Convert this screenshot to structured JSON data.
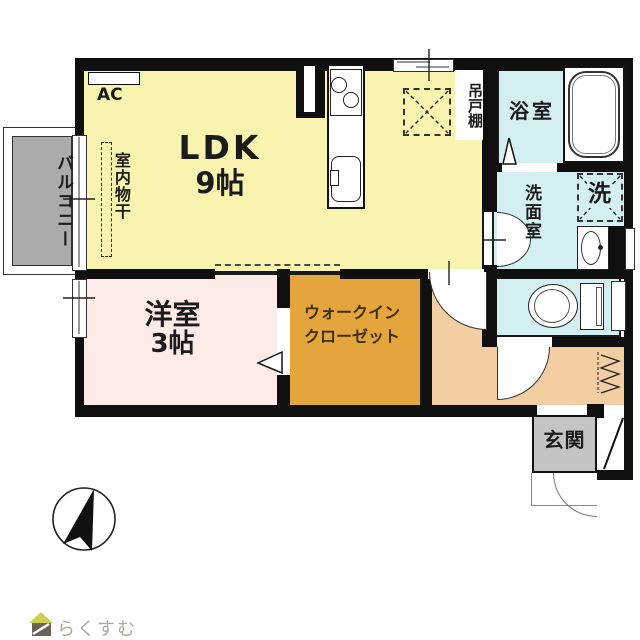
{
  "plan": {
    "rooms": {
      "ldk": {
        "name": "LDK",
        "size": "9帖"
      },
      "western_room": {
        "name": "洋室",
        "size": "3帖"
      },
      "walk_in_closet": {
        "line1": "ウォークイン",
        "line2": "クローゼット"
      },
      "bathroom": {
        "name": "浴室"
      },
      "washroom": {
        "name": "洗面室"
      },
      "entrance": {
        "name": "玄関"
      },
      "balcony": {
        "name": "バルコニー"
      }
    },
    "annotations": {
      "ac_unit": "AC",
      "indoor_drying": "室内物干",
      "hanging_cupboard": "吊戸棚",
      "washing_machine": "洗"
    },
    "colors": {
      "ldk": "#f8f4b0",
      "western_room": "#fcebe7",
      "walk_in_closet": "#e4a63c",
      "hallway": "#f3cea3",
      "wet_area": "#d3eff1",
      "balcony": "#ababab",
      "entrance_mat": "#c4c4c4",
      "wall": "#0f0f0f",
      "closet_text": "#3f2d06",
      "brand_text": "#b3a79f",
      "logo_roof": "#c9d14f",
      "logo_body": "#6b6156"
    },
    "footer": {
      "brand": "らくすむ"
    }
  }
}
